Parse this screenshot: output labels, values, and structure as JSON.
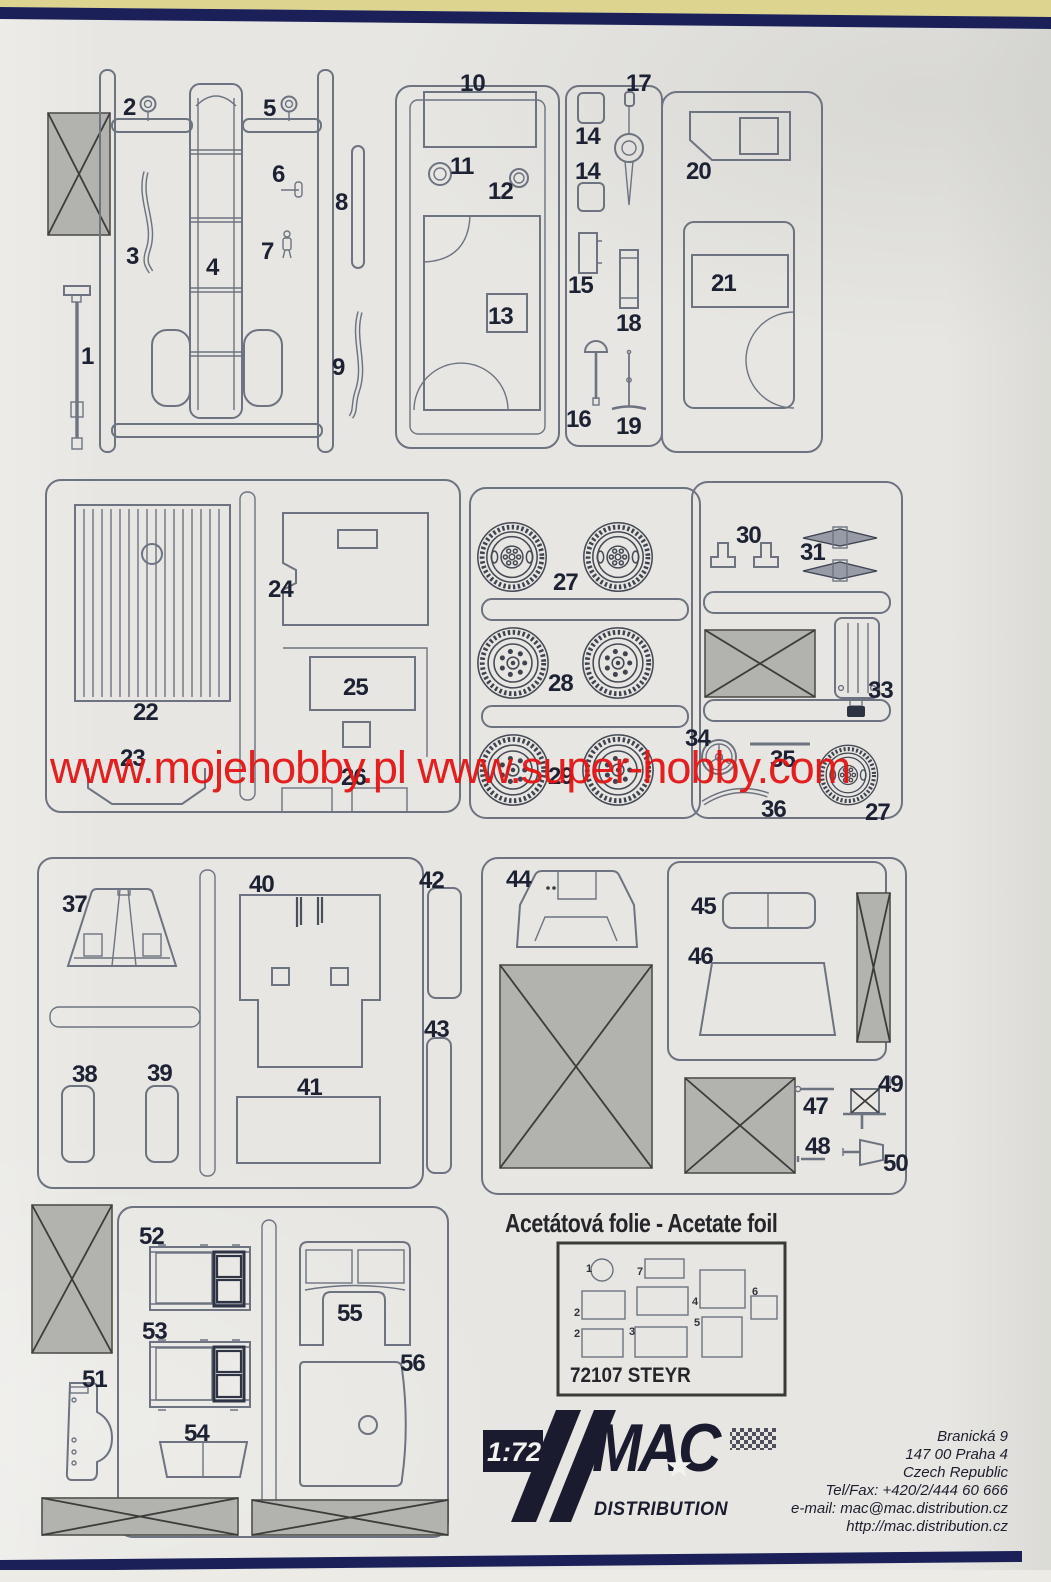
{
  "watermark": {
    "text": "www.mojehobby.pl www.super-hobby.com",
    "color": "#e31414"
  },
  "parts": {
    "p1": "1",
    "p2": "2",
    "p3": "3",
    "p4": "4",
    "p5": "5",
    "p6": "6",
    "p7": "7",
    "p8": "8",
    "p9": "9",
    "p10": "10",
    "p11": "11",
    "p12": "12",
    "p13": "13",
    "p14a": "14",
    "p14b": "14",
    "p15": "15",
    "p16": "16",
    "p17": "17",
    "p18": "18",
    "p19": "19",
    "p20": "20",
    "p21": "21",
    "p22": "22",
    "p23": "23",
    "p24": "24",
    "p25": "25",
    "p26": "26",
    "p27": "27",
    "p27b": "27",
    "p28": "28",
    "p29": "29",
    "p30": "30",
    "p31": "31",
    "p33": "33",
    "p34": "34",
    "p35": "35",
    "p36": "36",
    "p37": "37",
    "p38": "38",
    "p39": "39",
    "p40": "40",
    "p41": "41",
    "p42": "42",
    "p43": "43",
    "p44": "44",
    "p45": "45",
    "p46": "46",
    "p47": "47",
    "p48": "48",
    "p49": "49",
    "p50": "50",
    "p51": "51",
    "p52": "52",
    "p53": "53",
    "p54": "54",
    "p55": "55",
    "p56": "56"
  },
  "acetate": {
    "heading": "Acetátová folie - Acetate foil",
    "box_label": "72107 STEYR",
    "foil": {
      "f1": "1",
      "f2a": "2",
      "f2b": "2",
      "f3": "3",
      "f4": "4",
      "f5": "5",
      "f6": "6",
      "f7": "7"
    }
  },
  "footer": {
    "scale": "1:72",
    "brand": "MAC",
    "brand_sub": "DISTRIBUTION",
    "star_icon": "★",
    "address": [
      "Branická 9",
      "147 00 Praha 4",
      "Czech Republic",
      "Tel/Fax: +420/2/444 60 666",
      "e-mail: mac@mac.distribution.cz",
      "http://mac.distribution.cz"
    ]
  },
  "colors": {
    "paper": "#e7e6e2",
    "line": "#6d7380",
    "part_number": "#1c2133",
    "watermark_red": "#e31414",
    "navy_rule": "#1b2158",
    "top_yellow": "#ddd48f",
    "hatch_fill": "#b2b2ae",
    "logo_navy": "#1b1b30"
  }
}
